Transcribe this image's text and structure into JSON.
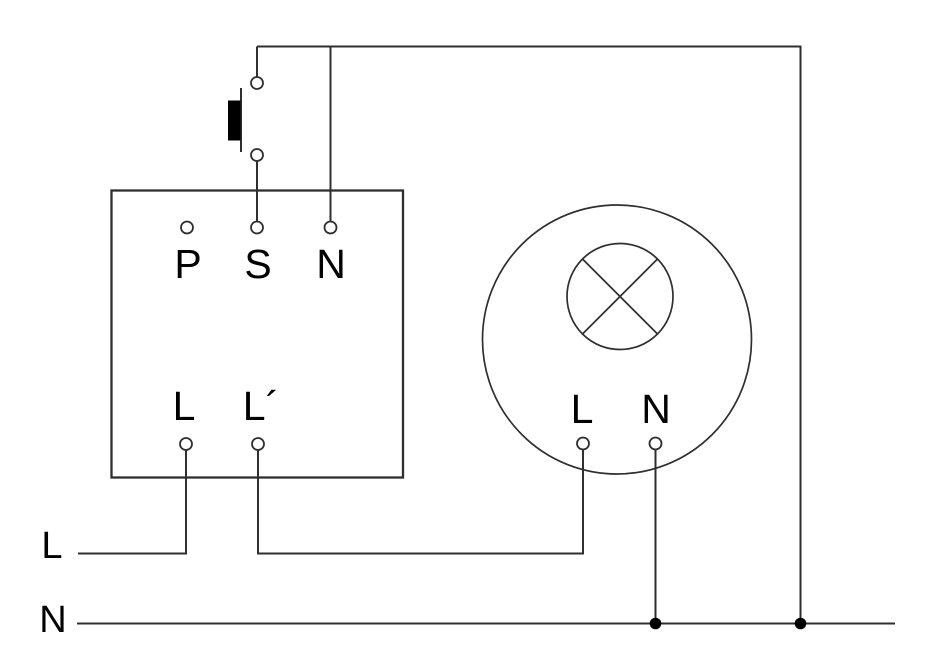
{
  "colors": {
    "background": "#ffffff",
    "wire": "#2f2f2f",
    "text": "#000000",
    "solid": "#000000"
  },
  "sensor_box": {
    "top_terminals": [
      "P",
      "S",
      "N"
    ],
    "bottom_terminals": [
      "L",
      "L´"
    ]
  },
  "lamp": {
    "terminals": [
      "L",
      "N"
    ]
  },
  "supply": {
    "live": "L",
    "neutral": "N"
  }
}
